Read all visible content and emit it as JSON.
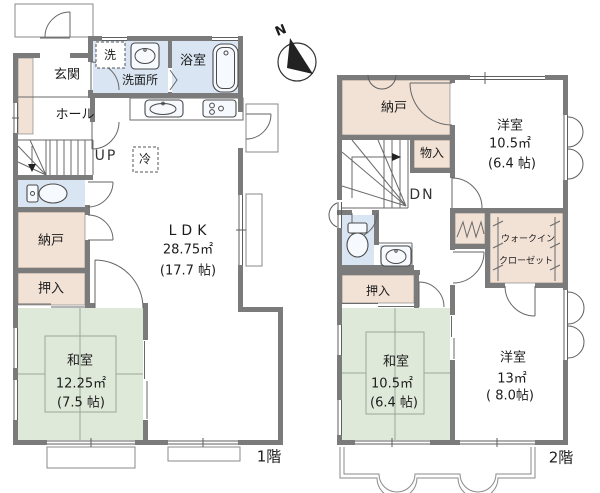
{
  "compass": {
    "north": "N"
  },
  "floor1": {
    "label": "1階",
    "entrance": "玄関",
    "hall": "ホール",
    "laundry": "洗",
    "washroom": "洗面所",
    "bathroom": "浴室",
    "stairs": "UP",
    "fridge": "冷",
    "ldk": {
      "name": "LDK",
      "area": "28.75㎡",
      "size": "(17.7 帖)"
    },
    "storage": "納戸",
    "closet": "押入",
    "tatami_room": {
      "name": "和室",
      "area": "12.25㎡",
      "size": "(7.5 帖)"
    }
  },
  "floor2": {
    "label": "2階",
    "storage": "納戸",
    "cabinet": "物入",
    "stairs": "DN",
    "bedroom_small": {
      "name": "洋室",
      "area": "10.5㎡",
      "size": "(6.4 帖)"
    },
    "walkin_closet": {
      "line1": "ウォークイン",
      "line2": "クローゼット"
    },
    "closet": "押入",
    "tatami_room": {
      "name": "和室",
      "area": "10.5㎡",
      "size": "(6.4 帖)"
    },
    "bedroom_large": {
      "name": "洋室",
      "area": "13㎡",
      "size": "( 8.0帖)"
    }
  },
  "colors": {
    "wall": "#7b7b7b",
    "wet": "#d9e5f2",
    "storage": "#f2e1d5",
    "tatami": "#dfe9da"
  }
}
